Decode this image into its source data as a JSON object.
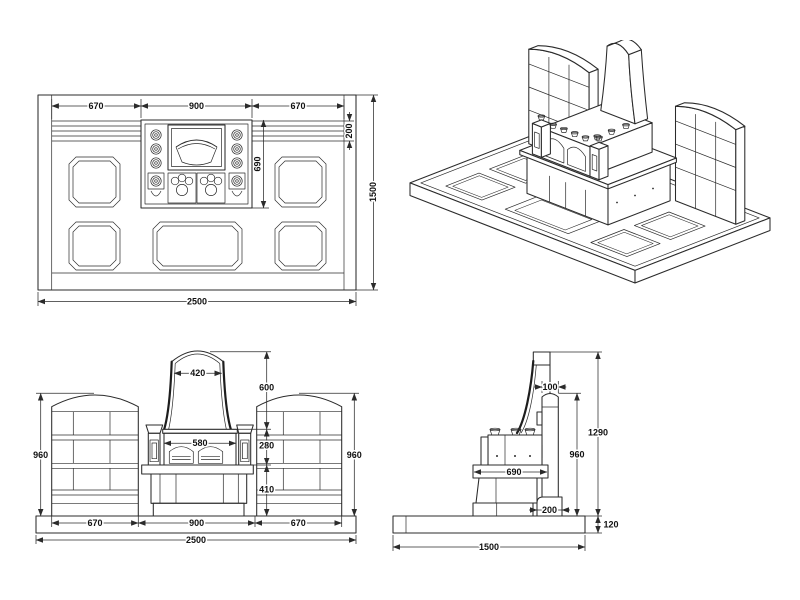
{
  "drawing": {
    "background": "#ffffff",
    "line_color": "#2b2b2b",
    "views": {
      "plan": {
        "dims": {
          "width_left": "670",
          "width_center": "900",
          "width_right": "670",
          "rail_depth": "200",
          "stand_depth": "690",
          "depth_total": "1500",
          "width_total": "2500"
        }
      },
      "front": {
        "dims": {
          "stone_top_width": "420",
          "stone_height": "600",
          "upper_stand_height": "280",
          "lower_stand_height": "410",
          "wall_height_left": "960",
          "wall_height_right": "960",
          "stand_inner_width": "580",
          "width_left": "670",
          "width_center": "900",
          "width_right": "670",
          "width_total": "2500"
        }
      },
      "side": {
        "dims": {
          "stone_thickness": "100",
          "monument_height": "1290",
          "wall_height": "960",
          "stand_depth": "690",
          "wall_base_depth": "200",
          "base_height": "120",
          "depth_total": "1500"
        }
      }
    }
  }
}
